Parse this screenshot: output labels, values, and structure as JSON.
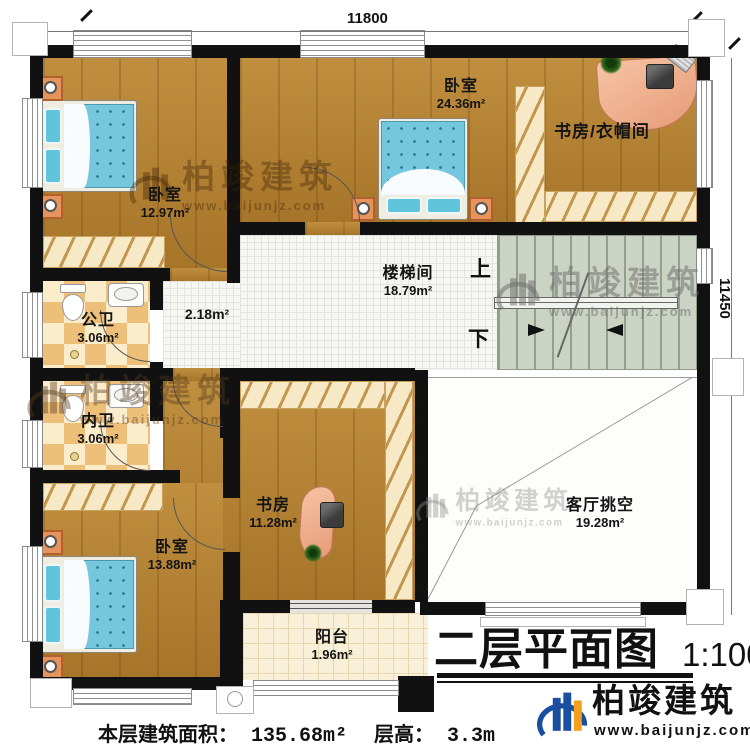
{
  "plan": {
    "dimensions": {
      "top_width": "11800",
      "right_height": "11450"
    },
    "rooms": {
      "bedroom_top_left": {
        "name": "卧室",
        "area": "12.97m²"
      },
      "bedroom_top_center": {
        "name": "卧室",
        "area": "24.36m²"
      },
      "study_cloakroom": {
        "name": "书房/衣帽间"
      },
      "stairwell": {
        "name": "楼梯间",
        "area": "18.79m²",
        "up": "上",
        "down": "下"
      },
      "public_bathroom": {
        "name": "公卫",
        "area": "3.06m²"
      },
      "hallway": {
        "area": "2.18m²"
      },
      "private_bathroom": {
        "name": "内卫",
        "area": "3.06m²"
      },
      "study": {
        "name": "书房",
        "area": "11.28m²"
      },
      "bedroom_bottom_left": {
        "name": "卧室",
        "area": "13.88m²"
      },
      "balcony": {
        "name": "阳台",
        "area": "1.96m²"
      },
      "living_room_void": {
        "name": "客厅挑空",
        "area": "19.28m²"
      }
    }
  },
  "title_block": {
    "title": "二层平面图",
    "scale": "1:100"
  },
  "footer": {
    "area_label": "本层建筑面积：",
    "area_value": "135.68m²",
    "floor_height_label": "层高：",
    "floor_height_value": "3.3m"
  },
  "brand": {
    "name": "柏竣建筑",
    "website": "www.baijunjz.com",
    "blue": "#1a4fa0",
    "orange": "#f5a01d"
  },
  "watermark": {
    "name": "柏竣建筑",
    "website": "www.baijunjz.com"
  }
}
